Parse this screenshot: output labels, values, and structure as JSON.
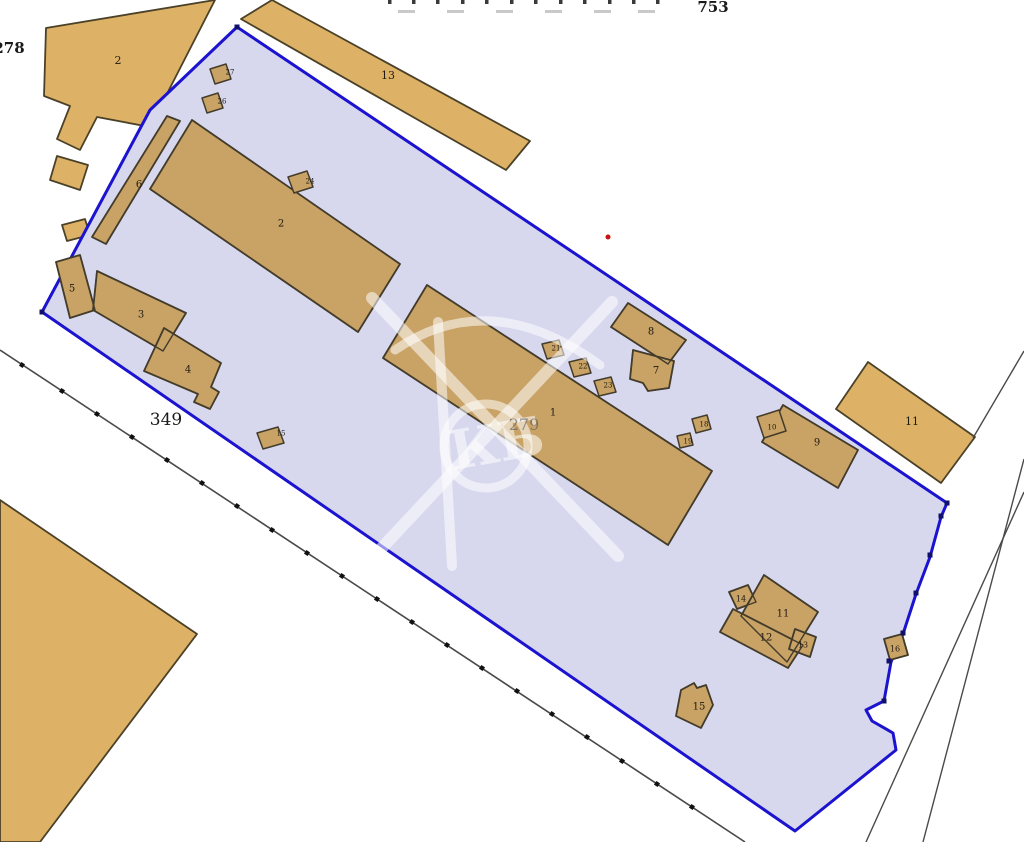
{
  "canvas": {
    "w": 1024,
    "h": 842,
    "bg": "#ffffff"
  },
  "palette": {
    "parcel_fill": "#d7d8ee",
    "parcel_stroke": "#1b13cf",
    "bld_out_fill": "#deb266",
    "bld_out_stroke": "#4a4128",
    "bld_in_fill": "#c9a265",
    "bld_in_stroke": "#433c2b",
    "road": "#4a4a4a",
    "tick": "#111111",
    "label": "#201a10",
    "red_dot": "#cc1111",
    "watermark": "rgba(255,255,255,0.55)",
    "faint_text": "rgba(85,85,95,0.6)",
    "frag_dark": "#3a3a3a",
    "frag_light": "#c9c9c9"
  },
  "texts": {
    "top_number": {
      "t": "753",
      "x": 699,
      "y": 12,
      "fs": 15,
      "bold": true
    },
    "left_number": {
      "t": "278",
      "x": -5,
      "y": 53,
      "fs": 15,
      "bold": true
    },
    "road_number": {
      "t": "349",
      "x": 152,
      "y": 425,
      "fs": 17,
      "bold": false
    },
    "parcel_number": {
      "t": "279",
      "x": 524,
      "y": 430,
      "fs": 16,
      "bold": false
    }
  },
  "top_fragments": {
    "dark_xs": [
      388,
      412,
      436,
      461,
      485,
      510,
      534,
      559,
      583,
      608,
      632,
      656
    ],
    "light_xs": [
      398,
      447,
      496,
      545,
      594,
      638
    ]
  },
  "parcel": {
    "points": [
      [
        237,
        27
      ],
      [
        947,
        503
      ],
      [
        941,
        517
      ],
      [
        930,
        557
      ],
      [
        916,
        594
      ],
      [
        903,
        634
      ],
      [
        891,
        662
      ],
      [
        884,
        701
      ],
      [
        866,
        710
      ],
      [
        872,
        721
      ],
      [
        893,
        733
      ],
      [
        896,
        750
      ],
      [
        795,
        831
      ],
      [
        42,
        312
      ],
      [
        150,
        110
      ]
    ],
    "vertex_dots": [
      [
        947,
        503
      ],
      [
        941,
        516
      ],
      [
        930,
        555
      ],
      [
        916,
        593
      ],
      [
        903,
        633
      ],
      [
        889,
        661
      ],
      [
        884,
        701
      ],
      [
        237,
        27
      ],
      [
        42,
        312
      ]
    ]
  },
  "roads": {
    "main_line": [
      [
        0,
        350
      ],
      [
        745,
        842
      ]
    ],
    "ticks": [
      [
        22,
        365
      ],
      [
        62,
        391
      ],
      [
        97,
        414
      ],
      [
        132,
        437
      ],
      [
        167,
        460
      ],
      [
        202,
        483
      ],
      [
        237,
        506
      ],
      [
        272,
        530
      ],
      [
        307,
        553
      ],
      [
        342,
        576
      ],
      [
        377,
        599
      ],
      [
        412,
        622
      ],
      [
        447,
        645
      ],
      [
        482,
        668
      ],
      [
        517,
        691
      ],
      [
        552,
        714
      ],
      [
        587,
        737
      ],
      [
        622,
        761
      ],
      [
        657,
        784
      ],
      [
        692,
        807
      ]
    ],
    "segments": [
      [
        [
          973,
          438
        ],
        [
          1024,
          351
        ]
      ],
      [
        [
          1024,
          492
        ],
        [
          866,
          842
        ]
      ],
      [
        [
          1024,
          459
        ],
        [
          923,
          842
        ]
      ]
    ]
  },
  "red_dot": {
    "x": 608,
    "y": 237,
    "r": 2.5
  },
  "watermark": {
    "letters": "КБ"
  },
  "buildings_outside": [
    {
      "label": "2",
      "points": [
        [
          46,
          28
        ],
        [
          215,
          0
        ],
        [
          150,
          127
        ],
        [
          97,
          117
        ],
        [
          80,
          150
        ],
        [
          57,
          139
        ],
        [
          70,
          106
        ],
        [
          44,
          96
        ]
      ],
      "label_xy": [
        118,
        60
      ]
    },
    {
      "label": "",
      "points": [
        [
          57,
          156
        ],
        [
          88,
          165
        ],
        [
          80,
          190
        ],
        [
          50,
          180
        ]
      ]
    },
    {
      "label": "",
      "points": [
        [
          62,
          225
        ],
        [
          85,
          219
        ],
        [
          90,
          235
        ],
        [
          67,
          241
        ]
      ]
    },
    {
      "label": "13",
      "points": [
        [
          241,
          19
        ],
        [
          272,
          0
        ],
        [
          530,
          141
        ],
        [
          506,
          170
        ]
      ],
      "label_xy": [
        388,
        75
      ]
    },
    {
      "label": "11",
      "points": [
        [
          868,
          362
        ],
        [
          975,
          437
        ],
        [
          941,
          483
        ],
        [
          836,
          409
        ]
      ],
      "label_xy": [
        912,
        421
      ]
    },
    {
      "label": "",
      "points": [
        [
          0,
          500
        ],
        [
          197,
          634
        ],
        [
          40,
          842
        ],
        [
          0,
          842
        ]
      ]
    }
  ],
  "buildings_inside": [
    {
      "label": "2",
      "points": [
        [
          192,
          120
        ],
        [
          400,
          264
        ],
        [
          358,
          332
        ],
        [
          150,
          189
        ]
      ],
      "label_xy": [
        281,
        223
      ]
    },
    {
      "label": "6",
      "points": [
        [
          167,
          116
        ],
        [
          180,
          121
        ],
        [
          106,
          244
        ],
        [
          92,
          237
        ]
      ],
      "label_xy": [
        139,
        184
      ]
    },
    {
      "label": "5",
      "points": [
        [
          56,
          262
        ],
        [
          80,
          255
        ],
        [
          95,
          310
        ],
        [
          70,
          318
        ]
      ],
      "label_xy": [
        72,
        288
      ]
    },
    {
      "label": "3",
      "points": [
        [
          97,
          271
        ],
        [
          186,
          313
        ],
        [
          163,
          351
        ],
        [
          93,
          310
        ]
      ],
      "label_xy": [
        141,
        314
      ]
    },
    {
      "label": "4",
      "points": [
        [
          164,
          328
        ],
        [
          221,
          363
        ],
        [
          211,
          387
        ],
        [
          219,
          392
        ],
        [
          210,
          409
        ],
        [
          194,
          402
        ],
        [
          198,
          394
        ],
        [
          144,
          371
        ]
      ],
      "label_xy": [
        188,
        369
      ]
    },
    {
      "label": "1",
      "points": [
        [
          427,
          285
        ],
        [
          712,
          471
        ],
        [
          668,
          545
        ],
        [
          383,
          358
        ]
      ],
      "label_xy": [
        553,
        412
      ]
    },
    {
      "label": "8",
      "points": [
        [
          628,
          303
        ],
        [
          686,
          340
        ],
        [
          668,
          364
        ],
        [
          611,
          327
        ]
      ],
      "label_xy": [
        651,
        331
      ]
    },
    {
      "label": "7",
      "points": [
        [
          633,
          350
        ],
        [
          674,
          361
        ],
        [
          669,
          388
        ],
        [
          648,
          391
        ],
        [
          643,
          383
        ],
        [
          630,
          379
        ]
      ],
      "label_xy": [
        656,
        370
      ]
    },
    {
      "label": "9",
      "points": [
        [
          783,
          405
        ],
        [
          858,
          450
        ],
        [
          838,
          488
        ],
        [
          762,
          442
        ]
      ],
      "label_xy": [
        817,
        442
      ]
    },
    {
      "label": "14",
      "points": [
        [
          729,
          592
        ],
        [
          748,
          585
        ],
        [
          756,
          602
        ],
        [
          737,
          609
        ]
      ],
      "label_xy": [
        741,
        598
      ],
      "fs": 8
    },
    {
      "label": "11",
      "points": [
        [
          764,
          575
        ],
        [
          818,
          612
        ],
        [
          787,
          662
        ],
        [
          741,
          616
        ]
      ],
      "label_xy": [
        783,
        613
      ]
    },
    {
      "label": "12",
      "points": [
        [
          733,
          609
        ],
        [
          803,
          645
        ],
        [
          788,
          668
        ],
        [
          720,
          632
        ]
      ],
      "label_xy": [
        766,
        637
      ]
    },
    {
      "label": "13",
      "points": [
        [
          795,
          629
        ],
        [
          816,
          637
        ],
        [
          810,
          657
        ],
        [
          789,
          649
        ]
      ],
      "label_xy": [
        803,
        644
      ],
      "fs": 8
    },
    {
      "label": "16",
      "points": [
        [
          884,
          639
        ],
        [
          902,
          634
        ],
        [
          908,
          655
        ],
        [
          890,
          660
        ]
      ],
      "label_xy": [
        895,
        648
      ],
      "fs": 8
    },
    {
      "label": "15",
      "points": [
        [
          681,
          690
        ],
        [
          694,
          683
        ],
        [
          697,
          688
        ],
        [
          706,
          685
        ],
        [
          713,
          705
        ],
        [
          701,
          728
        ],
        [
          676,
          716
        ]
      ],
      "label_xy": [
        699,
        706
      ]
    }
  ],
  "small_structures": [
    {
      "label": "27",
      "points": [
        [
          210,
          69
        ],
        [
          226,
          64
        ],
        [
          231,
          79
        ],
        [
          215,
          84
        ]
      ],
      "label_xy": [
        230,
        72
      ]
    },
    {
      "label": "26",
      "points": [
        [
          202,
          98
        ],
        [
          218,
          93
        ],
        [
          223,
          108
        ],
        [
          207,
          113
        ]
      ],
      "label_xy": [
        222,
        101
      ]
    },
    {
      "label": "24",
      "points": [
        [
          288,
          177
        ],
        [
          307,
          171
        ],
        [
          313,
          187
        ],
        [
          294,
          193
        ]
      ],
      "label_xy": [
        310,
        181
      ]
    },
    {
      "label": "21",
      "points": [
        [
          542,
          344
        ],
        [
          559,
          340
        ],
        [
          564,
          355
        ],
        [
          547,
          359
        ]
      ],
      "label_xy": [
        556,
        348
      ]
    },
    {
      "label": "22",
      "points": [
        [
          569,
          362
        ],
        [
          586,
          358
        ],
        [
          591,
          373
        ],
        [
          574,
          377
        ]
      ],
      "label_xy": [
        583,
        366
      ]
    },
    {
      "label": "23",
      "points": [
        [
          594,
          381
        ],
        [
          611,
          377
        ],
        [
          616,
          392
        ],
        [
          599,
          396
        ]
      ],
      "label_xy": [
        608,
        385
      ]
    },
    {
      "label": "18",
      "points": [
        [
          692,
          419
        ],
        [
          707,
          415
        ],
        [
          711,
          429
        ],
        [
          696,
          433
        ]
      ],
      "label_xy": [
        704,
        424
      ]
    },
    {
      "label": "19",
      "points": [
        [
          677,
          436
        ],
        [
          690,
          433
        ],
        [
          693,
          445
        ],
        [
          680,
          448
        ]
      ],
      "label_xy": [
        688,
        441
      ]
    },
    {
      "label": "10",
      "points": [
        [
          757,
          417
        ],
        [
          779,
          410
        ],
        [
          786,
          431
        ],
        [
          764,
          438
        ]
      ],
      "label_xy": [
        772,
        427
      ]
    },
    {
      "label": "15",
      "points": [
        [
          257,
          433
        ],
        [
          278,
          427
        ],
        [
          284,
          443
        ],
        [
          263,
          449
        ]
      ],
      "label_xy": [
        281,
        433
      ]
    }
  ]
}
